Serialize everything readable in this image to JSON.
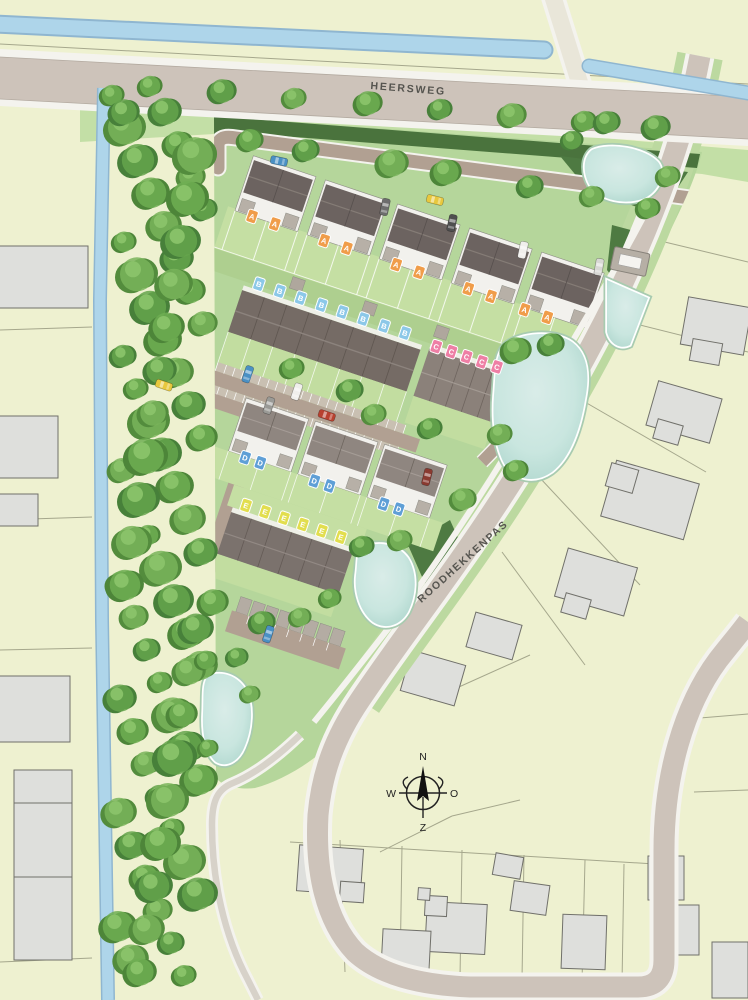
{
  "map": {
    "kind": "residential-development-site-plan",
    "streets": [
      {
        "id": "heersweg",
        "label": "HEERSWEG"
      },
      {
        "id": "roodhekkenpas",
        "label": "ROODHEKKENPAS"
      }
    ],
    "compass": {
      "north": "N",
      "east": "O",
      "south": "Z",
      "west": "W"
    },
    "house_types": [
      {
        "code": "A",
        "color": "#f09d4a"
      },
      {
        "code": "B",
        "color": "#8cc8e8"
      },
      {
        "code": "C",
        "color": "#ee7fa5"
      },
      {
        "code": "D",
        "color": "#5f9fd6"
      },
      {
        "code": "E",
        "color": "#e2de4e"
      }
    ],
    "site_markers": [
      {
        "type": "A",
        "x": 42,
        "y": 56
      },
      {
        "type": "A",
        "x": 66,
        "y": 56
      },
      {
        "type": "A",
        "x": 118,
        "y": 56
      },
      {
        "type": "A",
        "x": 142,
        "y": 56
      },
      {
        "type": "A",
        "x": 194,
        "y": 56
      },
      {
        "type": "A",
        "x": 218,
        "y": 56
      },
      {
        "type": "A",
        "x": 270,
        "y": 56
      },
      {
        "type": "A",
        "x": 294,
        "y": 56
      },
      {
        "type": "A",
        "x": 330,
        "y": 58
      },
      {
        "type": "A",
        "x": 354,
        "y": 58
      },
      {
        "type": "B",
        "x": 70,
        "y": 118
      },
      {
        "type": "B",
        "x": 92,
        "y": 118
      },
      {
        "type": "B",
        "x": 114,
        "y": 118
      },
      {
        "type": "B",
        "x": 136,
        "y": 118
      },
      {
        "type": "B",
        "x": 158,
        "y": 118
      },
      {
        "type": "B",
        "x": 180,
        "y": 118
      },
      {
        "type": "B",
        "x": 202,
        "y": 118
      },
      {
        "type": "B",
        "x": 224,
        "y": 118
      },
      {
        "type": "C",
        "x": 258,
        "y": 121
      },
      {
        "type": "C",
        "x": 274,
        "y": 121
      },
      {
        "type": "C",
        "x": 290,
        "y": 121
      },
      {
        "type": "C",
        "x": 306,
        "y": 121
      },
      {
        "type": "C",
        "x": 322,
        "y": 121
      },
      {
        "type": "D",
        "x": 112,
        "y": 287
      },
      {
        "type": "D",
        "x": 128,
        "y": 287
      },
      {
        "type": "D",
        "x": 185,
        "y": 287
      },
      {
        "type": "D",
        "x": 201,
        "y": 287
      },
      {
        "type": "D",
        "x": 258,
        "y": 287
      },
      {
        "type": "D",
        "x": 274,
        "y": 287
      },
      {
        "type": "E",
        "x": 128,
        "y": 332
      },
      {
        "type": "E",
        "x": 148,
        "y": 332
      },
      {
        "type": "E",
        "x": 168,
        "y": 332
      },
      {
        "type": "E",
        "x": 188,
        "y": 332
      },
      {
        "type": "E",
        "x": 208,
        "y": 332
      },
      {
        "type": "E",
        "x": 228,
        "y": 332
      }
    ],
    "cars_global": [
      {
        "color": "#4a90c4",
        "x": 279,
        "y": 161,
        "rot": 12
      },
      {
        "color": "#6d6d6d",
        "x": 385,
        "y": 207,
        "rot": 102
      },
      {
        "color": "#e8c83e",
        "x": 435,
        "y": 200,
        "rot": 14
      },
      {
        "color": "#4f4f4f",
        "x": 452,
        "y": 223,
        "rot": 102
      },
      {
        "color": "#f0efec",
        "x": 523,
        "y": 250,
        "rot": 102
      },
      {
        "color": "#d8d8d4",
        "x": 599,
        "y": 267,
        "rot": 100
      },
      {
        "color": "#8a3a30",
        "x": 427,
        "y": 477,
        "rot": 104
      }
    ],
    "cars_site": [
      {
        "color": "#4a90c4",
        "x": 88,
        "y": 207,
        "rot": 90
      },
      {
        "color": "#f0efec",
        "x": 140,
        "y": 208,
        "rot": 90
      },
      {
        "color": "#9a9a96",
        "x": 118,
        "y": 230,
        "rot": 90
      },
      {
        "color": "#b8412f",
        "x": 176,
        "y": 221,
        "rot": 0
      },
      {
        "color": "#e8c83e",
        "x": 12,
        "y": 244,
        "rot": 0
      },
      {
        "color": "#4a90c4",
        "x": 190,
        "y": 447,
        "rot": 90
      }
    ],
    "utility_box": {
      "present": true
    },
    "palette": {
      "background": "#eef1d0",
      "site_green": "#b5d69b",
      "verge_green": "#c3dfa6",
      "hedge_dark": "#4a733d",
      "main_road": "#cdc3ba",
      "internal_road": "#b1a092",
      "parking_bay": "#c9c0b2",
      "path_white": "#f4f3ee",
      "canal_blue": "#aed5ea",
      "pond_teal": "#c9e6df",
      "building_gray": "#dedfdc",
      "plot_line": "#a5a78c",
      "roof_dark": "#6c6360",
      "roof_mid": "#8f8680",
      "label_text": "#55544f"
    }
  }
}
